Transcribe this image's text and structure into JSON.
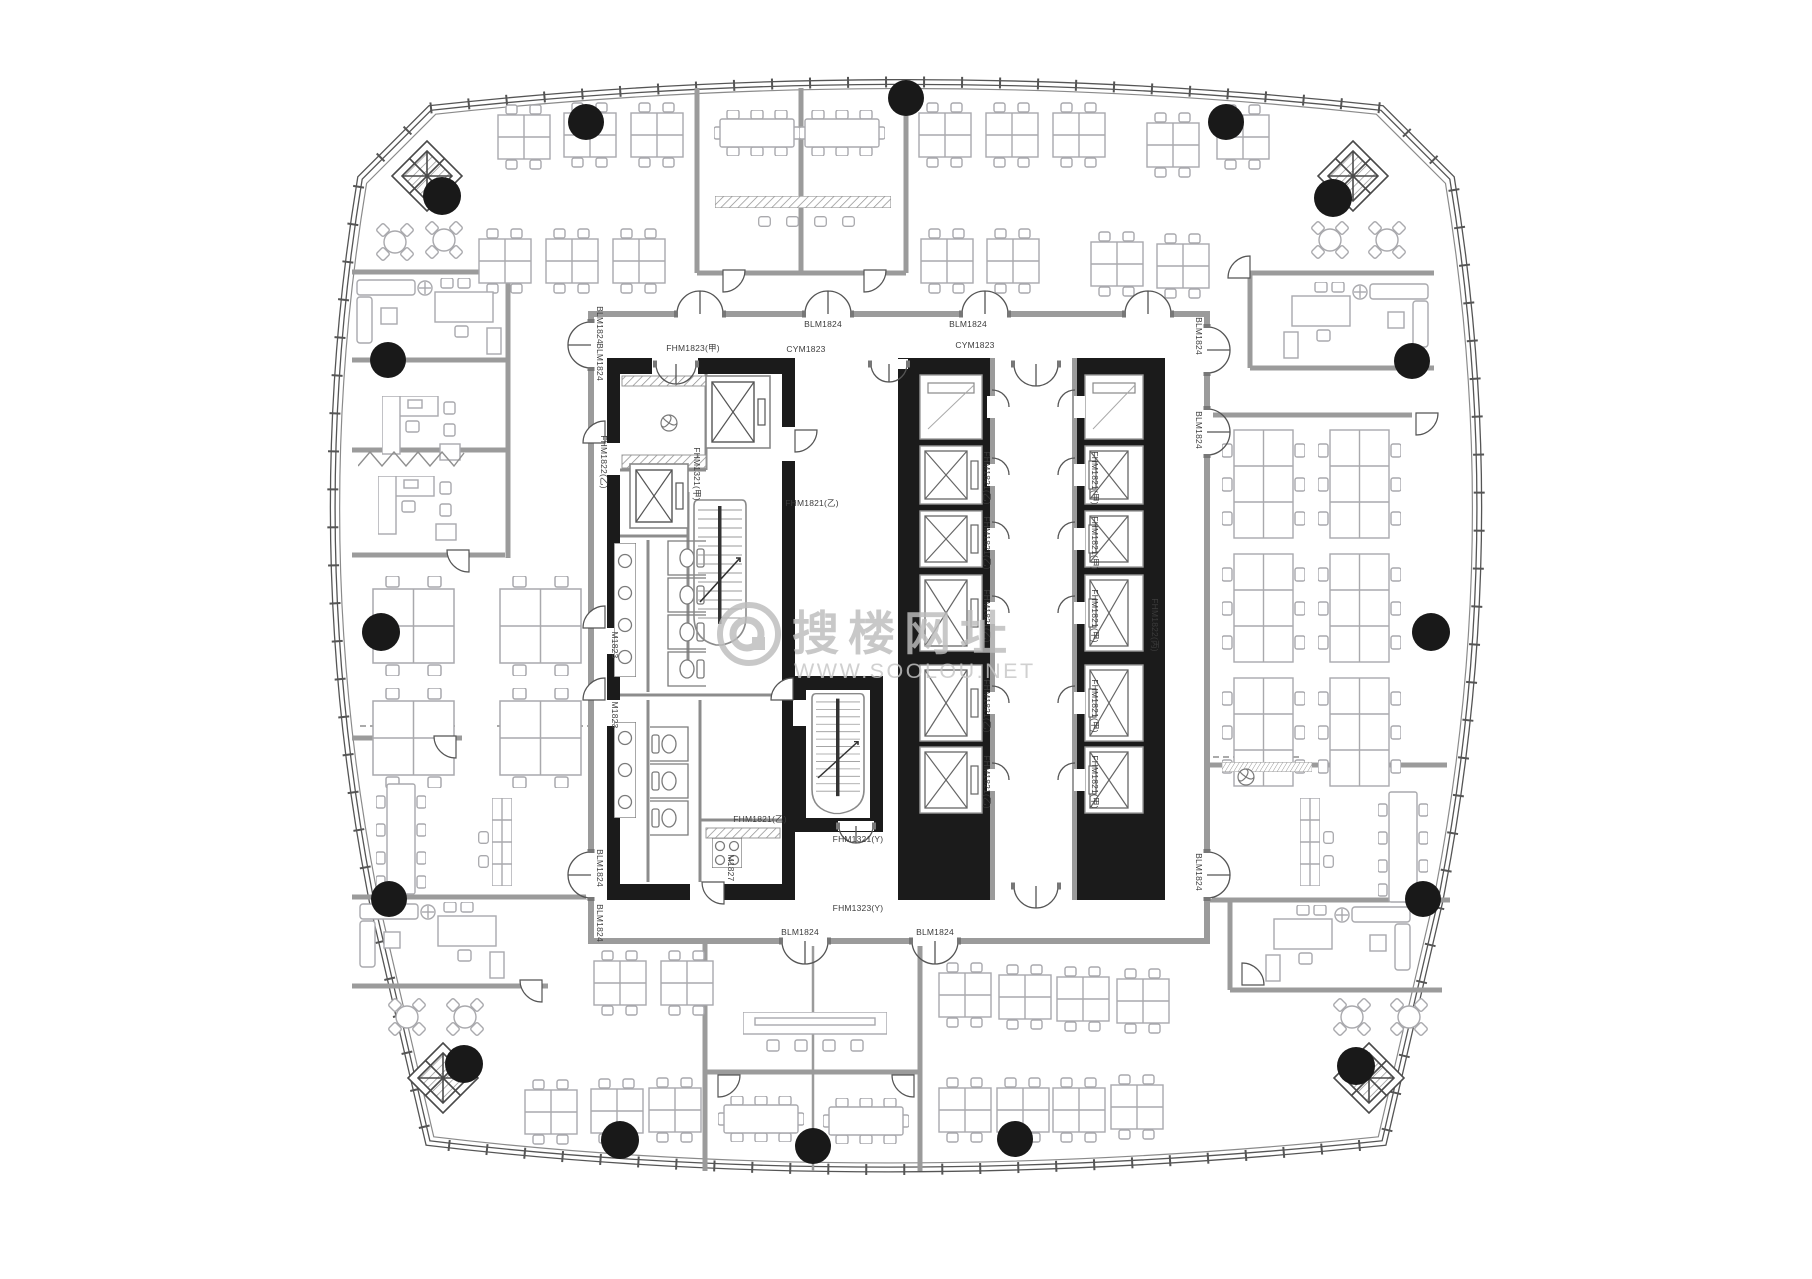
{
  "watermark": {
    "brand": "搜楼网址",
    "url": "WWW.SOOLOU.NET"
  },
  "colors": {
    "paper": "#ffffff",
    "wall_black": "#1b1b1b",
    "wall_gray": "#9b9b9b",
    "line": "#555555",
    "furniture": "#a9a9ad",
    "column": "#191919",
    "watermark": "#bdbdbd"
  },
  "plan": {
    "columns": [
      [
        586,
        122,
        18
      ],
      [
        906,
        98,
        18
      ],
      [
        1226,
        122,
        18
      ],
      [
        442,
        196,
        19
      ],
      [
        1333,
        198,
        19
      ],
      [
        388,
        360,
        18
      ],
      [
        381,
        632,
        19
      ],
      [
        389,
        899,
        18
      ],
      [
        1412,
        361,
        18
      ],
      [
        1431,
        632,
        19
      ],
      [
        1423,
        899,
        18
      ],
      [
        620,
        1140,
        19
      ],
      [
        813,
        1146,
        18
      ],
      [
        1015,
        1139,
        18
      ],
      [
        464,
        1064,
        19
      ],
      [
        1356,
        1066,
        19
      ]
    ],
    "door_labels": [
      {
        "t": "BLM1824",
        "x": 823,
        "y": 327,
        "r": 0
      },
      {
        "t": "BLM1824",
        "x": 968,
        "y": 327,
        "r": 0
      },
      {
        "t": "BLM1824",
        "x": 800,
        "y": 935,
        "r": 0
      },
      {
        "t": "BLM1824",
        "x": 935,
        "y": 935,
        "r": 0
      },
      {
        "t": "BLM1824",
        "x": 597,
        "y": 325,
        "r": 90
      },
      {
        "t": "BLM1824",
        "x": 597,
        "y": 362,
        "r": 90
      },
      {
        "t": "BLM1824",
        "x": 597,
        "y": 868,
        "r": 90
      },
      {
        "t": "BLM1824",
        "x": 597,
        "y": 923,
        "r": 90
      },
      {
        "t": "BLM1824",
        "x": 1196,
        "y": 336,
        "r": 90
      },
      {
        "t": "BLM1824",
        "x": 1196,
        "y": 430,
        "r": 90
      },
      {
        "t": "BLM1824",
        "x": 1196,
        "y": 872,
        "r": 90
      },
      {
        "t": "FHM1823(甲)",
        "x": 693,
        "y": 351,
        "r": 0
      },
      {
        "t": "CYM1823",
        "x": 806,
        "y": 352,
        "r": 0
      },
      {
        "t": "CYM1823",
        "x": 975,
        "y": 348,
        "r": 0
      },
      {
        "t": "FHM1821(乙)",
        "x": 812,
        "y": 506,
        "r": 0
      },
      {
        "t": "FHM1821(乙)",
        "x": 760,
        "y": 822,
        "r": 0
      },
      {
        "t": "FHM1321(Y)",
        "x": 858,
        "y": 842,
        "r": 0
      },
      {
        "t": "FHM1323(Y)",
        "x": 858,
        "y": 911,
        "r": 0
      },
      {
        "t": "FHM1822(乙)",
        "x": 601,
        "y": 462,
        "r": 90
      },
      {
        "t": "FHM1321(甲)",
        "x": 694,
        "y": 474,
        "r": 90
      },
      {
        "t": "FHM1822(丙)",
        "x": 1152,
        "y": 625,
        "r": 90
      },
      {
        "t": "M1823",
        "x": 612,
        "y": 645,
        "r": 90
      },
      {
        "t": "M1823",
        "x": 612,
        "y": 715,
        "r": 90
      },
      {
        "t": "M1827",
        "x": 728,
        "y": 868,
        "r": 90
      },
      {
        "t": "FHM1821(乙)",
        "x": 984,
        "y": 478,
        "r": 90
      },
      {
        "t": "FHM1821(乙)",
        "x": 984,
        "y": 543,
        "r": 90
      },
      {
        "t": "FHM1821(乙)",
        "x": 984,
        "y": 616,
        "r": 90
      },
      {
        "t": "FHM1821(乙)",
        "x": 984,
        "y": 706,
        "r": 90
      },
      {
        "t": "FHM1821(乙)",
        "x": 984,
        "y": 782,
        "r": 90
      },
      {
        "t": "FHM1821(甲)",
        "x": 1092,
        "y": 478,
        "r": 90
      },
      {
        "t": "FHM1821(甲)",
        "x": 1092,
        "y": 543,
        "r": 90
      },
      {
        "t": "FHM1821(甲)",
        "x": 1092,
        "y": 616,
        "r": 90
      },
      {
        "t": "FHM1821(甲)",
        "x": 1092,
        "y": 706,
        "r": 90
      },
      {
        "t": "FHM1821(甲)",
        "x": 1092,
        "y": 782,
        "r": 90
      }
    ],
    "furniture": [
      {
        "s": "ws4",
        "x": 497,
        "y": 104
      },
      {
        "s": "ws4",
        "x": 563,
        "y": 102
      },
      {
        "s": "ws4",
        "x": 630,
        "y": 102
      },
      {
        "s": "ws4",
        "x": 478,
        "y": 228
      },
      {
        "s": "ws4",
        "x": 545,
        "y": 228
      },
      {
        "s": "ws4",
        "x": 612,
        "y": 228
      },
      {
        "s": "ws4",
        "x": 918,
        "y": 102
      },
      {
        "s": "ws4",
        "x": 985,
        "y": 102
      },
      {
        "s": "ws4",
        "x": 1052,
        "y": 102
      },
      {
        "s": "ws4",
        "x": 1146,
        "y": 112
      },
      {
        "s": "ws4",
        "x": 1216,
        "y": 104
      },
      {
        "s": "ws4",
        "x": 920,
        "y": 228
      },
      {
        "s": "ws4",
        "x": 986,
        "y": 228
      },
      {
        "s": "ws4",
        "x": 1090,
        "y": 231
      },
      {
        "s": "ws4",
        "x": 1156,
        "y": 233
      },
      {
        "s": "ws4",
        "x": 593,
        "y": 950
      },
      {
        "s": "ws4",
        "x": 660,
        "y": 950
      },
      {
        "s": "ws4",
        "x": 938,
        "y": 962
      },
      {
        "s": "ws4",
        "x": 998,
        "y": 964
      },
      {
        "s": "ws4",
        "x": 1056,
        "y": 966
      },
      {
        "s": "ws4",
        "x": 1116,
        "y": 968
      },
      {
        "s": "ws4",
        "x": 524,
        "y": 1079
      },
      {
        "s": "ws4",
        "x": 590,
        "y": 1078
      },
      {
        "s": "ws4",
        "x": 648,
        "y": 1077
      },
      {
        "s": "ws4",
        "x": 938,
        "y": 1077
      },
      {
        "s": "ws4",
        "x": 996,
        "y": 1077
      },
      {
        "s": "ws4",
        "x": 1052,
        "y": 1077
      },
      {
        "s": "ws4",
        "x": 1110,
        "y": 1074
      },
      {
        "s": "ws4L",
        "x": 371,
        "y": 576
      },
      {
        "s": "ws4L",
        "x": 498,
        "y": 576
      },
      {
        "s": "ws4L",
        "x": 371,
        "y": 688
      },
      {
        "s": "ws4L",
        "x": 498,
        "y": 688
      },
      {
        "s": "ws6v",
        "x": 1222,
        "y": 428
      },
      {
        "s": "ws6v",
        "x": 1318,
        "y": 428
      },
      {
        "s": "ws6v",
        "x": 1222,
        "y": 552
      },
      {
        "s": "ws6v",
        "x": 1318,
        "y": 552
      },
      {
        "s": "ws6v",
        "x": 1222,
        "y": 676
      },
      {
        "s": "ws6v",
        "x": 1318,
        "y": 676
      },
      {
        "s": "mtg8h",
        "x": 714,
        "y": 110
      },
      {
        "s": "mtg8h",
        "x": 799,
        "y": 110
      },
      {
        "s": "mtg8h",
        "x": 718,
        "y": 1096
      },
      {
        "s": "mtg8h",
        "x": 823,
        "y": 1098
      },
      {
        "s": "mtg8v",
        "x": 376,
        "y": 778
      },
      {
        "s": "mtg8v",
        "x": 1378,
        "y": 786,
        "f": 1
      },
      {
        "s": "round4",
        "x": 375,
        "y": 222
      },
      {
        "s": "round4",
        "x": 424,
        "y": 220
      },
      {
        "s": "round4",
        "x": 1310,
        "y": 220
      },
      {
        "s": "round4",
        "x": 1367,
        "y": 220
      },
      {
        "s": "round4",
        "x": 387,
        "y": 997
      },
      {
        "s": "round4",
        "x": 445,
        "y": 997
      },
      {
        "s": "round4",
        "x": 1332,
        "y": 997
      },
      {
        "s": "round4",
        "x": 1389,
        "y": 997
      },
      {
        "s": "longtable",
        "x": 743,
        "y": 1012
      },
      {
        "s": "counterh",
        "x": 715,
        "y": 196
      },
      {
        "s": "counterh",
        "x": 1222,
        "y": 762,
        "w": 90,
        "h": 10
      },
      {
        "s": "chair",
        "x": 758,
        "y": 216
      },
      {
        "s": "chair",
        "x": 786,
        "y": 216
      },
      {
        "s": "chair",
        "x": 814,
        "y": 216
      },
      {
        "s": "chair",
        "x": 842,
        "y": 216
      },
      {
        "s": "chair",
        "x": 477,
        "y": 832,
        "r": 90
      },
      {
        "s": "chair",
        "x": 477,
        "y": 856,
        "r": 90
      },
      {
        "s": "chair",
        "x": 1322,
        "y": 832,
        "r": 90
      },
      {
        "s": "chair",
        "x": 1322,
        "y": 856,
        "r": 90
      },
      {
        "s": "exec",
        "x": 355,
        "y": 278
      },
      {
        "s": "exec",
        "x": 1280,
        "y": 282,
        "f": 1
      },
      {
        "s": "exec",
        "x": 358,
        "y": 902
      },
      {
        "s": "exec",
        "x": 1262,
        "y": 905,
        "f": 1
      },
      {
        "s": "cab",
        "x": 492,
        "y": 798
      },
      {
        "s": "cab",
        "x": 1300,
        "y": 798
      },
      {
        "s": "ldesk",
        "x": 382,
        "y": 396
      },
      {
        "s": "ldesk",
        "x": 378,
        "y": 476
      },
      {
        "s": "zigzag",
        "x": 358,
        "y": 451
      },
      {
        "s": "stall",
        "x": 660,
        "y": 540
      },
      {
        "s": "stall",
        "x": 660,
        "y": 577
      },
      {
        "s": "stall",
        "x": 660,
        "y": 614
      },
      {
        "s": "stall",
        "x": 660,
        "y": 651
      },
      {
        "s": "stall",
        "x": 650,
        "y": 726,
        "f": 1
      },
      {
        "s": "stall",
        "x": 650,
        "y": 763,
        "f": 1
      },
      {
        "s": "stall",
        "x": 650,
        "y": 800,
        "f": 1
      },
      {
        "s": "sinks4",
        "x": 614,
        "y": 543
      },
      {
        "s": "sinks3",
        "x": 614,
        "y": 722
      },
      {
        "s": "stove",
        "x": 712,
        "y": 838
      },
      {
        "s": "fan",
        "x": 660,
        "y": 414
      },
      {
        "s": "fan",
        "x": 1237,
        "y": 768
      },
      {
        "s": "stair",
        "x": 692,
        "y": 498
      },
      {
        "s": "stair",
        "x": 810,
        "y": 692,
        "w": 56,
        "h": 124
      },
      {
        "s": "brace",
        "x": 390,
        "y": 139
      },
      {
        "s": "brace",
        "x": 1316,
        "y": 139
      },
      {
        "s": "brace",
        "x": 406,
        "y": 1041
      },
      {
        "s": "brace",
        "x": 1332,
        "y": 1041
      }
    ],
    "elevators": [
      {
        "x": 706,
        "y": 376,
        "w": 64,
        "h": 72
      },
      {
        "x": 630,
        "y": 464,
        "w": 58,
        "h": 64
      }
    ],
    "banks": [
      {
        "slabX": 898,
        "slabW": 92,
        "cellX": 920,
        "cellW": 62,
        "doorWallX": 990,
        "door": "E",
        "cells": [
          [
            375,
            64,
            "s"
          ],
          [
            446,
            58,
            "x"
          ],
          [
            511,
            56,
            "x"
          ],
          [
            575,
            76,
            "x"
          ],
          [
            665,
            76,
            "x"
          ],
          [
            747,
            66,
            "x"
          ]
        ]
      },
      {
        "slabX": 1077,
        "slabW": 88,
        "cellX": 1085,
        "cellW": 58,
        "doorWallX": 1072,
        "door": "W",
        "cells": [
          [
            375,
            64,
            "s"
          ],
          [
            446,
            58,
            "x"
          ],
          [
            511,
            56,
            "x"
          ],
          [
            575,
            76,
            "x"
          ],
          [
            665,
            76,
            "x"
          ],
          [
            747,
            66,
            "x"
          ]
        ]
      }
    ],
    "double_doors": [
      {
        "x": 700,
        "y": 314,
        "r": 0
      },
      {
        "x": 828,
        "y": 314,
        "r": 0
      },
      {
        "x": 985,
        "y": 314,
        "r": 0
      },
      {
        "x": 1148,
        "y": 314,
        "r": 0
      },
      {
        "x": 805,
        "y": 941,
        "r": 180
      },
      {
        "x": 935,
        "y": 941,
        "r": 180
      },
      {
        "x": 591,
        "y": 345,
        "r": 270
      },
      {
        "x": 591,
        "y": 875,
        "r": 270
      },
      {
        "x": 1207,
        "y": 350,
        "r": 90
      },
      {
        "x": 1207,
        "y": 432,
        "r": 90
      },
      {
        "x": 1207,
        "y": 875,
        "r": 90
      },
      {
        "x": 676,
        "y": 364,
        "r": 180,
        "w": 40
      },
      {
        "x": 889,
        "y": 364,
        "r": 180,
        "w": 36
      },
      {
        "x": 1036,
        "y": 364,
        "r": 180,
        "w": 44
      },
      {
        "x": 856,
        "y": 826,
        "r": 180,
        "w": 34
      },
      {
        "x": 1036,
        "y": 886,
        "r": 180,
        "w": 44
      }
    ],
    "single_doors": [
      {
        "x": 795,
        "y": 430,
        "r": 0
      },
      {
        "x": 605,
        "y": 443,
        "r": 180
      },
      {
        "x": 605,
        "y": 628,
        "r": 180
      },
      {
        "x": 605,
        "y": 700,
        "r": 180
      },
      {
        "x": 793,
        "y": 700,
        "r": 180
      },
      {
        "x": 724,
        "y": 882,
        "r": 90
      },
      {
        "x": 469,
        "y": 550,
        "r": 90
      },
      {
        "x": 456,
        "y": 736,
        "r": 90
      },
      {
        "x": 542,
        "y": 980,
        "r": 90
      },
      {
        "x": 1250,
        "y": 278,
        "r": 180
      },
      {
        "x": 1242,
        "y": 985,
        "r": 270
      },
      {
        "x": 718,
        "y": 1075,
        "r": 0
      },
      {
        "x": 914,
        "y": 1075,
        "r": 90
      },
      {
        "x": 723,
        "y": 270,
        "r": 0
      },
      {
        "x": 864,
        "y": 270,
        "r": 0
      },
      {
        "x": 1416,
        "y": 413,
        "r": 0
      }
    ]
  }
}
